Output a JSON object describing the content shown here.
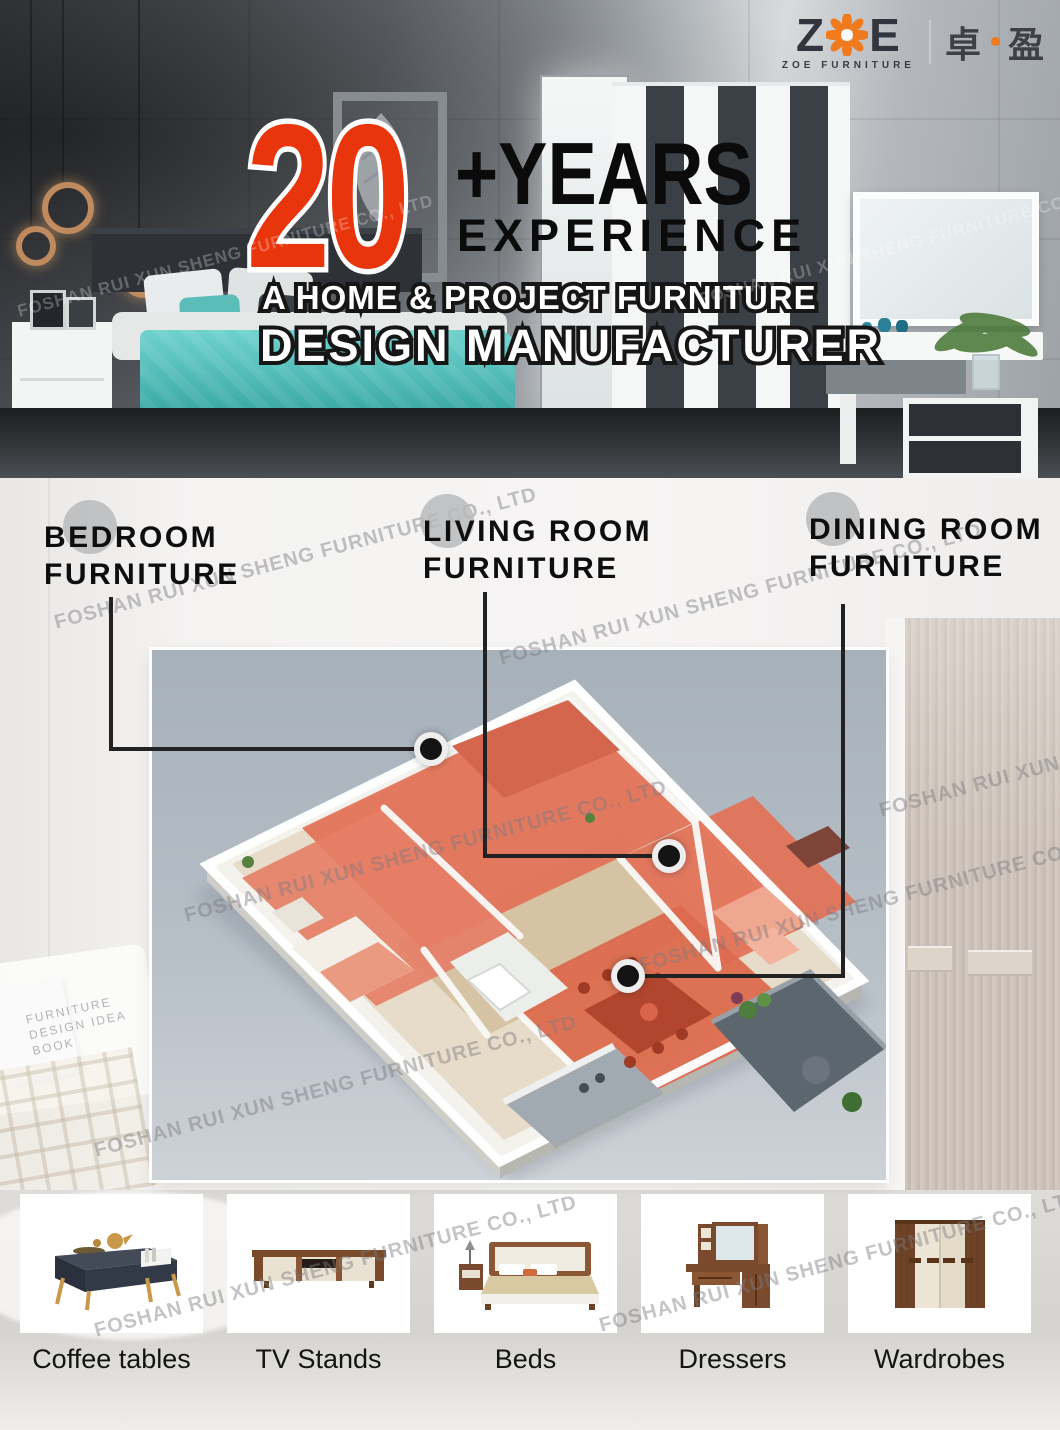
{
  "watermark": {
    "text": "FOSHAN RUI XUN SHENG FURNITURE CO., LTD"
  },
  "logo": {
    "letter_z": "Z",
    "letter_e": "E",
    "sub_text": "ZOE FURNITURE",
    "cn_left": "卓",
    "cn_right": "盈",
    "accent_orange": "#f07a1e"
  },
  "hero": {
    "number": "20",
    "plus_years": "+YEARS",
    "experience": "EXPERIENCE",
    "tagline1": "A HOME & PROJECT FURNITURE",
    "tagline2": "DESIGN MANUFACTURER",
    "accent_red": "#e8350c"
  },
  "categories": [
    {
      "line1": "BEDROOM",
      "line2": "FURNITURE"
    },
    {
      "line1": "LIVING ROOM",
      "line2": "FURNITURE"
    },
    {
      "line1": "DINING ROOM",
      "line2": "FURNITURE"
    }
  ],
  "floorplan": {
    "room_highlight_color": "#e1735a",
    "marker_color": "#141414",
    "backdrop_color": "#b3bcc4"
  },
  "products": [
    {
      "label": "Coffee tables"
    },
    {
      "label": "TV Stands"
    },
    {
      "label": "Beds"
    },
    {
      "label": "Dressers"
    },
    {
      "label": "Wardrobes"
    }
  ],
  "background": {
    "book_text": "FURNITURE DESIGN IDEA BOOK"
  }
}
